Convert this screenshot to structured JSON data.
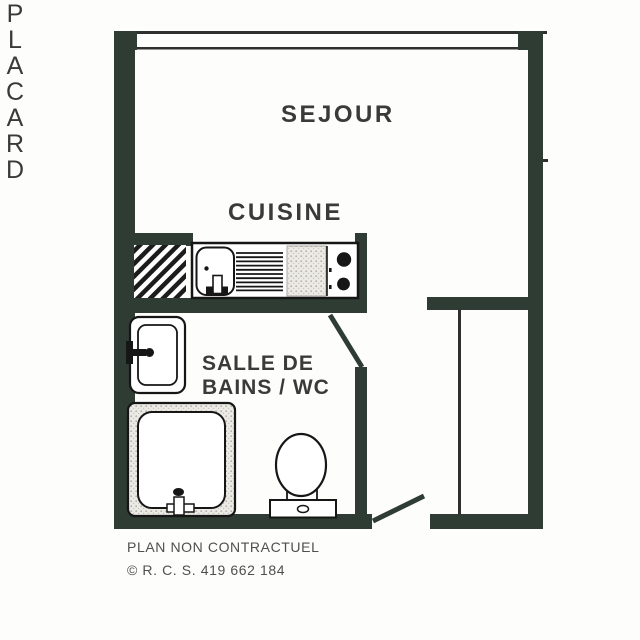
{
  "plan": {
    "rooms": {
      "sejour": "SEJOUR",
      "cuisine": "CUISINE",
      "salle_de_bains": "SALLE DE\nBAINS / WC",
      "placard": "PLACARD"
    },
    "footer": {
      "disclaimer": "PLAN NON CONTRACTUEL",
      "copyright": "© R. C. S. 419 662 184"
    },
    "colors": {
      "wall": "#2e3c33",
      "line": "#2f2f2f",
      "label": "#3a3a3a",
      "footer_text": "#4f4f4f",
      "fixture_outline": "#161616",
      "background": "#fdfdfc"
    },
    "icons": [
      "window-icon",
      "duct-hatch-icon",
      "kitchen-sink-icon",
      "drainboard-icon",
      "worktop-icon",
      "stove-burners-icon",
      "washbasin-icon",
      "shower-tray-icon",
      "toilet-icon",
      "door-swing-icon"
    ]
  }
}
